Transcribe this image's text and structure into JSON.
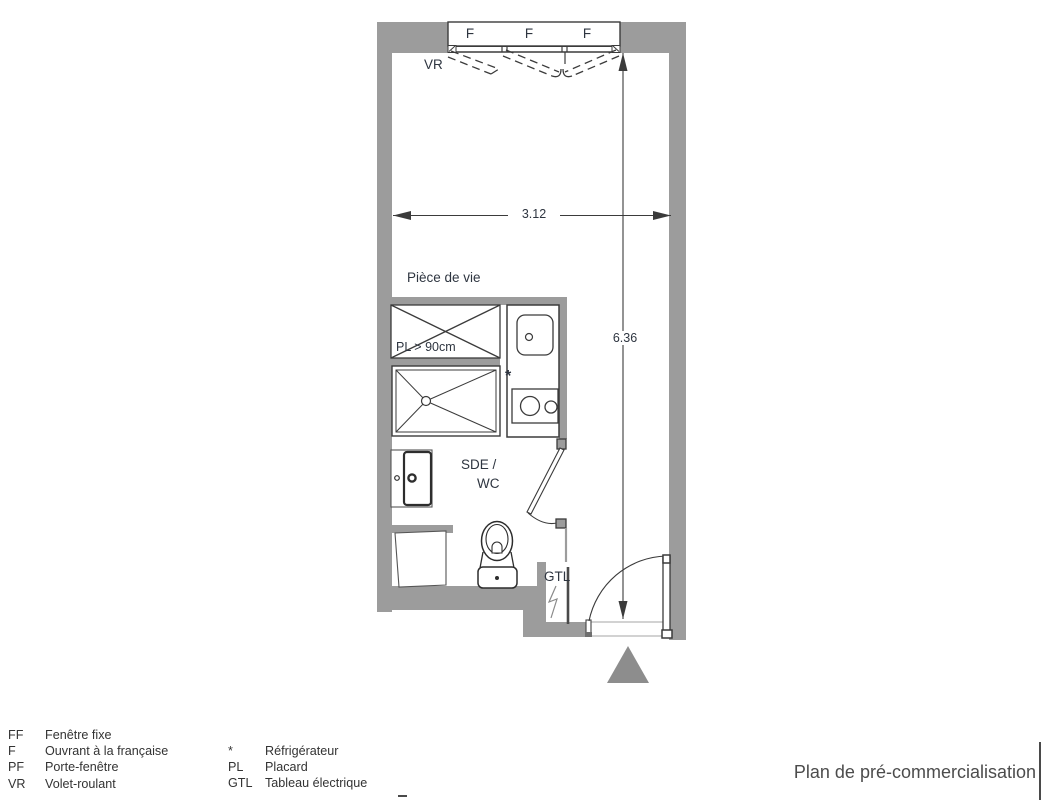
{
  "colors": {
    "wall_gray": "#9c9c9c",
    "line_dark": "#3b3b3b",
    "text_dark": "#2e3540",
    "triangle_gray": "#8d8d8d",
    "title_gray": "#4c4c4c",
    "threshold_gray": "#b8b8b8"
  },
  "plan": {
    "rooms": {
      "living": "Pièce de vie",
      "bathroom_line1": "SDE /",
      "bathroom_line2": "WC"
    },
    "window": {
      "sashes": [
        "F",
        "F",
        "F"
      ],
      "shutter": "VR"
    },
    "fixtures": {
      "closet": "PL > 90cm",
      "electrical": "GTL",
      "fridge": "*"
    },
    "dimensions": {
      "width_m": "3.12",
      "height_m": "6.36"
    }
  },
  "legend": {
    "col1": [
      {
        "abbr": "FF",
        "label": "Fenêtre fixe"
      },
      {
        "abbr": "F",
        "label": "Ouvrant à la française"
      },
      {
        "abbr": "PF",
        "label": "Porte-fenêtre"
      },
      {
        "abbr": "VR",
        "label": "Volet-roulant"
      }
    ],
    "col2": [
      {
        "abbr": "*",
        "label": "Réfrigérateur"
      },
      {
        "abbr": "PL",
        "label": "Placard"
      },
      {
        "abbr": "GTL",
        "label": "Tableau électrique"
      }
    ]
  },
  "footer": {
    "plan_title": "Plan de pré-commercialisation"
  }
}
